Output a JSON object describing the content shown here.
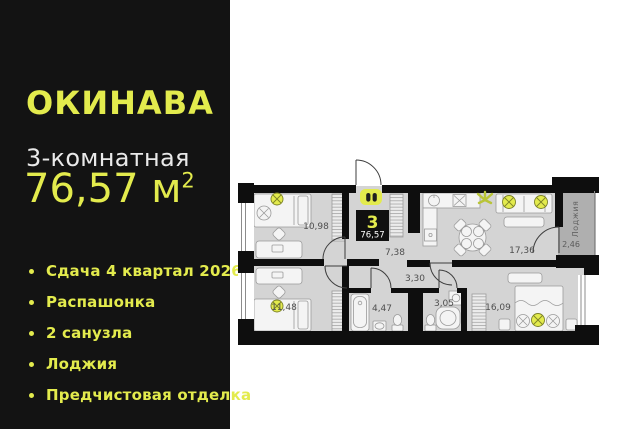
{
  "left_panel": {
    "logo": "ОКИНАВА",
    "room_type": "3-комнатная",
    "area_value": "76,57 м",
    "area_superscript": "2",
    "features": [
      {
        "label": "Сдача 4 квартал 2026"
      },
      {
        "label": "Распашонка"
      },
      {
        "label": "2 санузла"
      },
      {
        "label": "Лоджия"
      },
      {
        "label": "Предчистовая отделка"
      }
    ]
  },
  "floor_plan": {
    "badge": {
      "rooms_count": "3",
      "total_area": "76,57"
    },
    "entrance_icon": "people-pair-icon",
    "rooms": [
      {
        "name": "bedroom-top-left",
        "area": "10,98"
      },
      {
        "name": "hallway",
        "area": "7,38"
      },
      {
        "name": "kitchen-living-room",
        "area": "17,36"
      },
      {
        "name": "loggia",
        "area": "2,46",
        "label": "Лоджия"
      },
      {
        "name": "bedroom-bottom-left",
        "area": "11,48"
      },
      {
        "name": "inner-hall",
        "area": "3,30"
      },
      {
        "name": "bathroom-main",
        "area": "4,47"
      },
      {
        "name": "bathroom-second",
        "area": "3,05"
      },
      {
        "name": "bedroom-bottom-right",
        "area": "16,09"
      }
    ]
  },
  "colors": {
    "accent": "#E3EB4D",
    "panel_bg": "#131313",
    "floor": "#D4D4D4",
    "loggia_floor": "#AFAFAF",
    "walls": "#0E0E0E"
  }
}
